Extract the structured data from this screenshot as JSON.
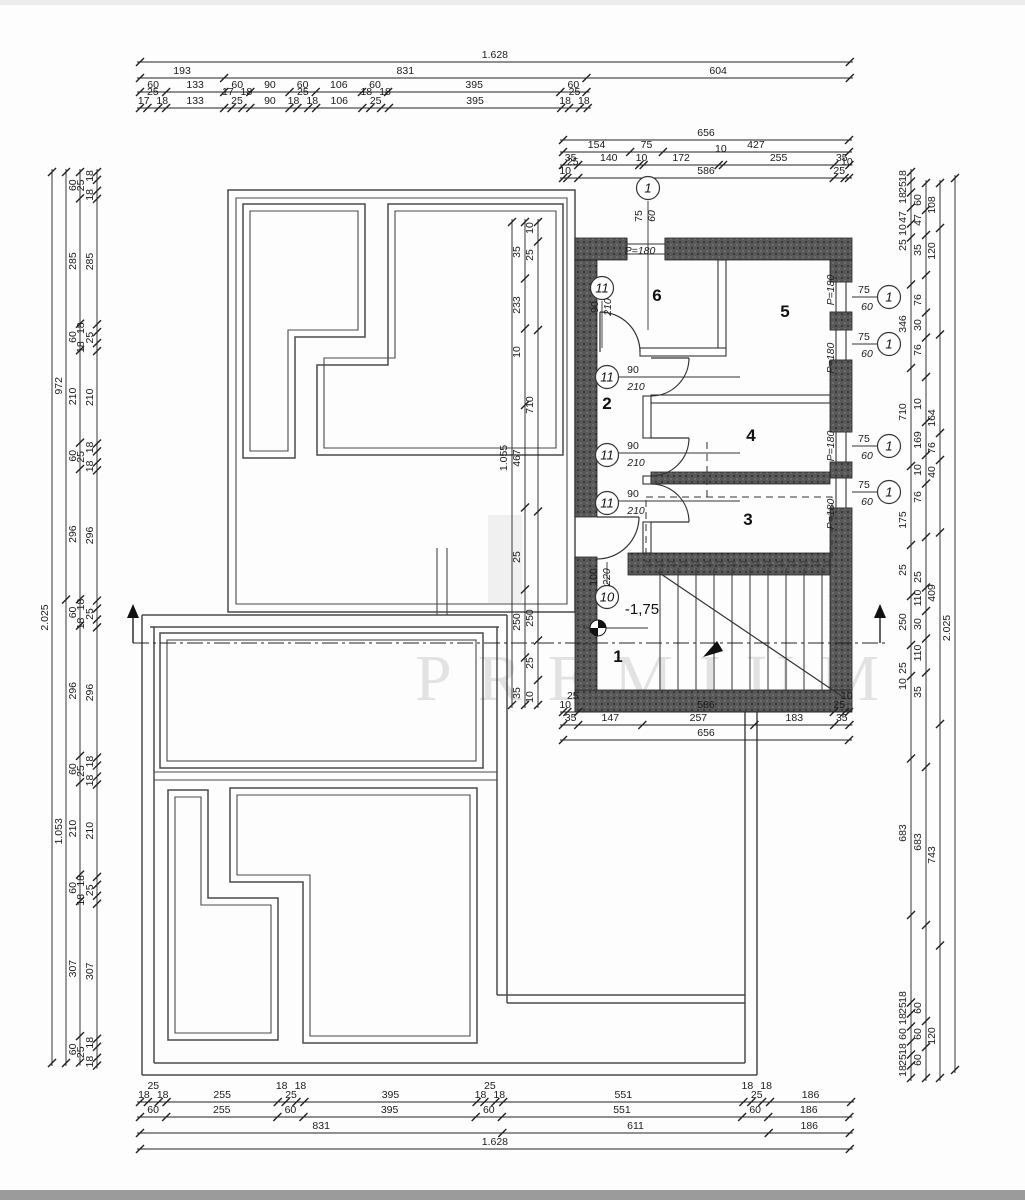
{
  "watermark": {
    "text": "PREMIUM"
  },
  "level_mark": {
    "text": "-1,75",
    "x": 642,
    "y": 614
  },
  "rooms": [
    {
      "t": "1",
      "x": 618,
      "y": 662
    },
    {
      "t": "2",
      "x": 607,
      "y": 409
    },
    {
      "t": "3",
      "x": 748,
      "y": 525
    },
    {
      "t": "4",
      "x": 751,
      "y": 441
    },
    {
      "t": "5",
      "x": 785,
      "y": 317
    },
    {
      "t": "6",
      "x": 657,
      "y": 301
    }
  ],
  "circled_refs": [
    {
      "t": "1",
      "x": 648,
      "y": 188
    },
    {
      "t": "1",
      "x": 889,
      "y": 297
    },
    {
      "t": "1",
      "x": 889,
      "y": 344
    },
    {
      "t": "1",
      "x": 889,
      "y": 446
    },
    {
      "t": "1",
      "x": 889,
      "y": 492
    },
    {
      "t": "11",
      "x": 602,
      "y": 288
    },
    {
      "t": "11",
      "x": 607,
      "y": 377
    },
    {
      "t": "11",
      "x": 607,
      "y": 455
    },
    {
      "t": "11",
      "x": 607,
      "y": 503
    },
    {
      "t": "10",
      "x": 607,
      "y": 597
    }
  ],
  "fraction_labels": [
    {
      "a": "75",
      "b": "60",
      "x": 648,
      "y": 216,
      "rot": true
    },
    {
      "a": "75",
      "b": "60",
      "x": 864,
      "y": 297,
      "rot": false
    },
    {
      "a": "75",
      "b": "60",
      "x": 864,
      "y": 344,
      "rot": false
    },
    {
      "a": "75",
      "b": "60",
      "x": 864,
      "y": 446,
      "rot": false
    },
    {
      "a": "75",
      "b": "60",
      "x": 864,
      "y": 492,
      "rot": false
    },
    {
      "a": "90",
      "b": "210",
      "x": 604,
      "y": 307,
      "rot": true
    },
    {
      "a": "90",
      "b": "210",
      "x": 633,
      "y": 377,
      "rot": false
    },
    {
      "a": "90",
      "b": "210",
      "x": 633,
      "y": 453,
      "rot": false
    },
    {
      "a": "90",
      "b": "210",
      "x": 633,
      "y": 501,
      "rot": false
    },
    {
      "a": "100",
      "b": "220",
      "x": 603,
      "y": 577,
      "rot": true
    }
  ],
  "window_labels": [
    {
      "t": "P=180",
      "x": 640,
      "y": 254,
      "rot": false
    },
    {
      "t": "P=180",
      "x": 834,
      "y": 290,
      "rot": true
    },
    {
      "t": "P=180",
      "x": 834,
      "y": 358,
      "rot": true
    },
    {
      "t": "P=180",
      "x": 834,
      "y": 446,
      "rot": true
    },
    {
      "t": "P=180",
      "x": 834,
      "y": 514,
      "rot": true
    }
  ],
  "chains": [
    {
      "id": "top-1",
      "o": "h",
      "line": 62,
      "p0": 140,
      "s": 0.436,
      "vals": [
        "1.628"
      ]
    },
    {
      "id": "top-2",
      "o": "h",
      "line": 78,
      "p0": 140,
      "s": 0.436,
      "vals": [
        "193",
        "831",
        "604"
      ]
    },
    {
      "id": "top-3",
      "o": "h",
      "line": 92,
      "p0": 140,
      "s": 0.436,
      "vals": [
        "60",
        "133",
        "60",
        "90",
        "60",
        "106",
        "60",
        "395",
        "60"
      ]
    },
    {
      "id": "top-4",
      "o": "h",
      "line": 108,
      "p0": 140,
      "s": 0.436,
      "vals": [
        "17",
        "25",
        "18",
        "133",
        "17",
        "25",
        "18",
        "90",
        "18",
        "25",
        "18",
        "106",
        "18",
        "25",
        "18",
        "395",
        "18",
        "25",
        "18"
      ]
    },
    {
      "id": "upper-1",
      "o": "h",
      "line": 140,
      "p0": 563,
      "s": 0.436,
      "vals": [
        "656"
      ]
    },
    {
      "id": "upper-2",
      "o": "h",
      "line": 152,
      "p0": 563,
      "s": 0.436,
      "vals": [
        "154",
        "75",
        "427"
      ]
    },
    {
      "id": "upper-3",
      "o": "h",
      "line": 165,
      "p0": 563,
      "s": 0.436,
      "vals": [
        "35",
        "140",
        "10",
        "172",
        "10",
        "255",
        "35"
      ]
    },
    {
      "id": "upper-4",
      "o": "h",
      "line": 178,
      "p0": 563,
      "s": 0.436,
      "vals": [
        "10",
        "25",
        "586",
        "25",
        "10"
      ]
    },
    {
      "id": "mid-1",
      "o": "h",
      "line": 712,
      "p0": 563,
      "s": 0.436,
      "vals": [
        "10",
        "25",
        "586",
        "25",
        "10"
      ]
    },
    {
      "id": "mid-2",
      "o": "h",
      "line": 725,
      "p0": 563,
      "s": 0.436,
      "vals": [
        "35",
        "147",
        "257",
        "183",
        "35"
      ]
    },
    {
      "id": "mid-3",
      "o": "h",
      "line": 740,
      "p0": 563,
      "s": 0.436,
      "vals": [
        "656"
      ]
    },
    {
      "id": "bot-1",
      "o": "h",
      "line": 1102,
      "p0": 140,
      "s": 0.436,
      "vals": [
        "18",
        "25",
        "18",
        "255",
        "18",
        "25",
        "18",
        "395",
        "18",
        "25",
        "18",
        "551",
        "18",
        "25",
        "18",
        "186"
      ]
    },
    {
      "id": "bot-2",
      "o": "h",
      "line": 1117,
      "p0": 140,
      "s": 0.436,
      "vals": [
        "60",
        "255",
        "60",
        "395",
        "60",
        "551",
        "60",
        "186"
      ]
    },
    {
      "id": "bot-3",
      "o": "h",
      "line": 1133,
      "p0": 140,
      "s": 0.436,
      "vals": [
        "831",
        "611",
        "186"
      ]
    },
    {
      "id": "bot-4",
      "o": "h",
      "line": 1149,
      "p0": 140,
      "s": 0.436,
      "vals": [
        "1.628"
      ]
    },
    {
      "id": "left-1",
      "o": "v",
      "line": 52,
      "p0": 172,
      "s": 0.44,
      "vals": [
        "2.025"
      ]
    },
    {
      "id": "left-2",
      "o": "v",
      "line": 66,
      "p0": 172,
      "s": 0.44,
      "vals": [
        "972",
        "1.053"
      ]
    },
    {
      "id": "left-3",
      "o": "v",
      "line": 80,
      "p0": 172,
      "s": 0.44,
      "vals": [
        "60",
        "285",
        "60",
        "210",
        "60",
        "296",
        "60",
        "296",
        "60",
        "210",
        "60",
        "307",
        "60"
      ]
    },
    {
      "id": "left-4",
      "o": "v",
      "line": 97,
      "p0": 172,
      "s": 0.44,
      "vals": [
        "18",
        "25",
        "18",
        "285",
        "18",
        "25",
        "18",
        "210",
        "18",
        "25",
        "18",
        "296",
        "18",
        "25",
        "18",
        "296",
        "18",
        "25",
        "18",
        "210",
        "18",
        "25",
        "18",
        "307",
        "18",
        "25",
        "18"
      ]
    },
    {
      "id": "right-1",
      "o": "v",
      "line": 911,
      "p0": 172,
      "p1": 1078,
      "labels": [
        [
          "18",
          176
        ],
        [
          "25",
          187
        ],
        [
          "18",
          198
        ],
        [
          "47",
          217
        ],
        [
          "10",
          230
        ],
        [
          "25",
          245
        ],
        [
          "346",
          324
        ],
        [
          "710",
          412
        ],
        [
          "175",
          520
        ],
        [
          "25",
          570
        ],
        [
          "250",
          622
        ],
        [
          "25",
          668
        ],
        [
          "10",
          684
        ],
        [
          "683",
          833
        ],
        [
          "18",
          997
        ],
        [
          "25",
          1008
        ],
        [
          "18",
          1019
        ],
        [
          "60",
          1034
        ],
        [
          "18",
          1049
        ],
        [
          "25",
          1060
        ],
        [
          "18",
          1071
        ]
      ]
    },
    {
      "id": "right-2",
      "o": "v",
      "line": 926,
      "p0": 183,
      "p1": 1078,
      "labels": [
        [
          "60",
          200
        ],
        [
          "47",
          220
        ],
        [
          "35",
          250
        ],
        [
          "76",
          300
        ],
        [
          "30",
          325
        ],
        [
          "76",
          350
        ],
        [
          "10",
          404
        ],
        [
          "169",
          440
        ],
        [
          "10",
          470
        ],
        [
          "76",
          497
        ],
        [
          "25",
          577
        ],
        [
          "110",
          598
        ],
        [
          "30",
          624
        ],
        [
          "110",
          653
        ],
        [
          "35",
          692
        ],
        [
          "683",
          842
        ],
        [
          "60",
          1008
        ],
        [
          "60",
          1034
        ],
        [
          "60",
          1060
        ]
      ]
    },
    {
      "id": "right-3",
      "o": "v",
      "line": 940,
      "p0": 183,
      "p1": 1078,
      "labels": [
        [
          "108",
          205
        ],
        [
          "120",
          251
        ],
        [
          "164",
          418
        ],
        [
          "76",
          448
        ],
        [
          "40",
          472
        ],
        [
          "409",
          593
        ],
        [
          "743",
          855
        ],
        [
          "120",
          1036
        ]
      ]
    },
    {
      "id": "right-4",
      "o": "v",
      "line": 955,
      "p0": 178,
      "p1": 1070,
      "labels": [
        [
          "2.025",
          628
        ]
      ]
    },
    {
      "id": "inner-1",
      "o": "v",
      "line": 512,
      "p0": 222,
      "p1": 705,
      "labels": [
        [
          "1.055",
          458
        ]
      ]
    },
    {
      "id": "inner-2",
      "o": "v",
      "line": 525,
      "p0": 222,
      "p1": 705,
      "labels": [
        [
          "35",
          252
        ],
        [
          "233",
          305
        ],
        [
          "10",
          352
        ],
        [
          "467",
          458
        ],
        [
          "25",
          557
        ],
        [
          "250",
          622
        ],
        [
          "35",
          693
        ]
      ]
    },
    {
      "id": "inner-3",
      "o": "v",
      "line": 538,
      "p0": 222,
      "p1": 705,
      "labels": [
        [
          "10",
          228
        ],
        [
          "25",
          255
        ],
        [
          "710",
          405
        ],
        [
          "250",
          618
        ],
        [
          "25",
          663
        ],
        [
          "10",
          697
        ]
      ]
    }
  ]
}
